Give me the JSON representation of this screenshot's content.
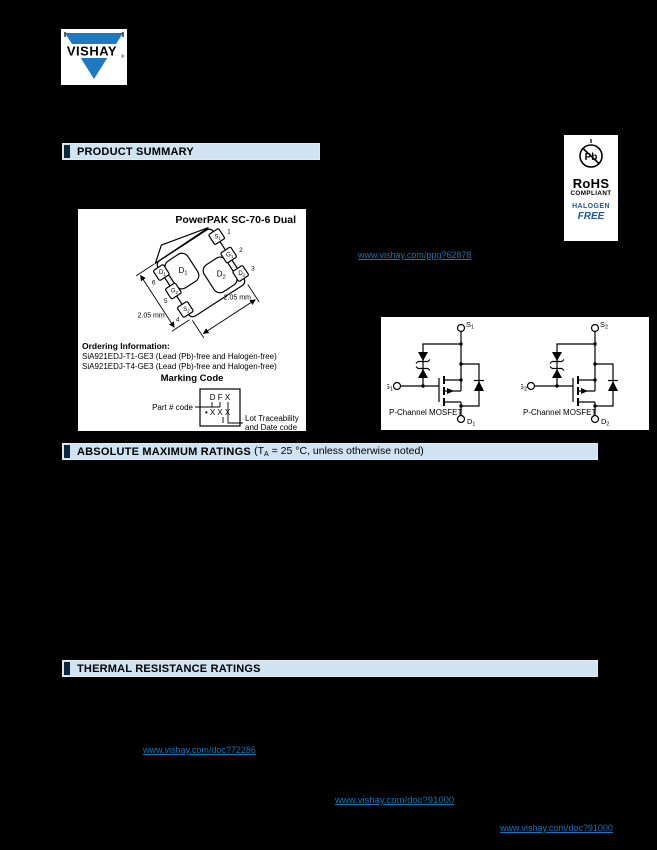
{
  "colors": {
    "page_background": "#000000",
    "header_bar_bg": "#cfe3f2",
    "header_tab": "#0b2740",
    "link_blue": "#1276bc",
    "logo_blue": "#1d79c0",
    "halogen_blue": "#2156a8"
  },
  "logo": {
    "brand": "VISHAY",
    "registered": "®"
  },
  "sections": {
    "product_summary": "PRODUCT SUMMARY",
    "absolute_max": {
      "title": "ABSOLUTE MAXIMUM RATINGS ",
      "cond_pre": "(T",
      "cond_sub": "A",
      "cond_post": " = 25 °C, unless otherwise noted)"
    },
    "thermal": "THERMAL RESISTANCE RATINGS"
  },
  "rohs": {
    "pb": "Pb",
    "rohs": "RoHS",
    "compliant": "COMPLIANT",
    "halogen": "HALOGEN",
    "free": "FREE"
  },
  "package_figure": {
    "title": "PowerPAK SC-70-6 Dual",
    "pads": [
      {
        "base": "D",
        "sub": "1"
      },
      {
        "base": "D",
        "sub": "2"
      }
    ],
    "pins": [
      {
        "num": "1",
        "base": "S",
        "sub": "1"
      },
      {
        "num": "2",
        "base": "G",
        "sub": "1"
      },
      {
        "num": "3",
        "base": "D",
        "sub": "2"
      },
      {
        "num": "4",
        "base": "S",
        "sub": "2"
      },
      {
        "num": "5",
        "base": "G",
        "sub": "2"
      },
      {
        "num": "6",
        "base": "D",
        "sub": "1"
      }
    ],
    "dim_left": "2.05 mm",
    "dim_right": "2.05 mm",
    "ordering_heading": "Ordering Information:",
    "ordering_lines": [
      "SiA921EDJ-T1-GE3 (Lead (Pb)-free and Halogen-free)",
      "SiA921EDJ-T4-GE3 (Lead (Pb)-free and Halogen-free)"
    ],
    "marking": {
      "heading": "Marking Code",
      "row1": "D F X",
      "row2_bullet": "•",
      "row2": "X X X",
      "part_label": "Part # code",
      "lot_label1": "Lot Traceability",
      "lot_label2": "and Date code"
    }
  },
  "circuits": {
    "caption": "P-Channel MOSFET",
    "left": {
      "s": "S",
      "s_sub": "1",
      "g": "G",
      "g_sub": "1",
      "d": "D",
      "d_sub": "1"
    },
    "right": {
      "s": "S",
      "s_sub": "2",
      "g": "G",
      "g_sub": "2",
      "d": "D",
      "d_sub": "2"
    }
  },
  "links": {
    "product_page": "www.vishay.com/ppg?62878",
    "soldering": "www.vishay.com/doc?72286",
    "disclaimer1": "www.vishay.com/doc?91000",
    "disclaimer2": "www.vishay.com/doc?91000"
  }
}
